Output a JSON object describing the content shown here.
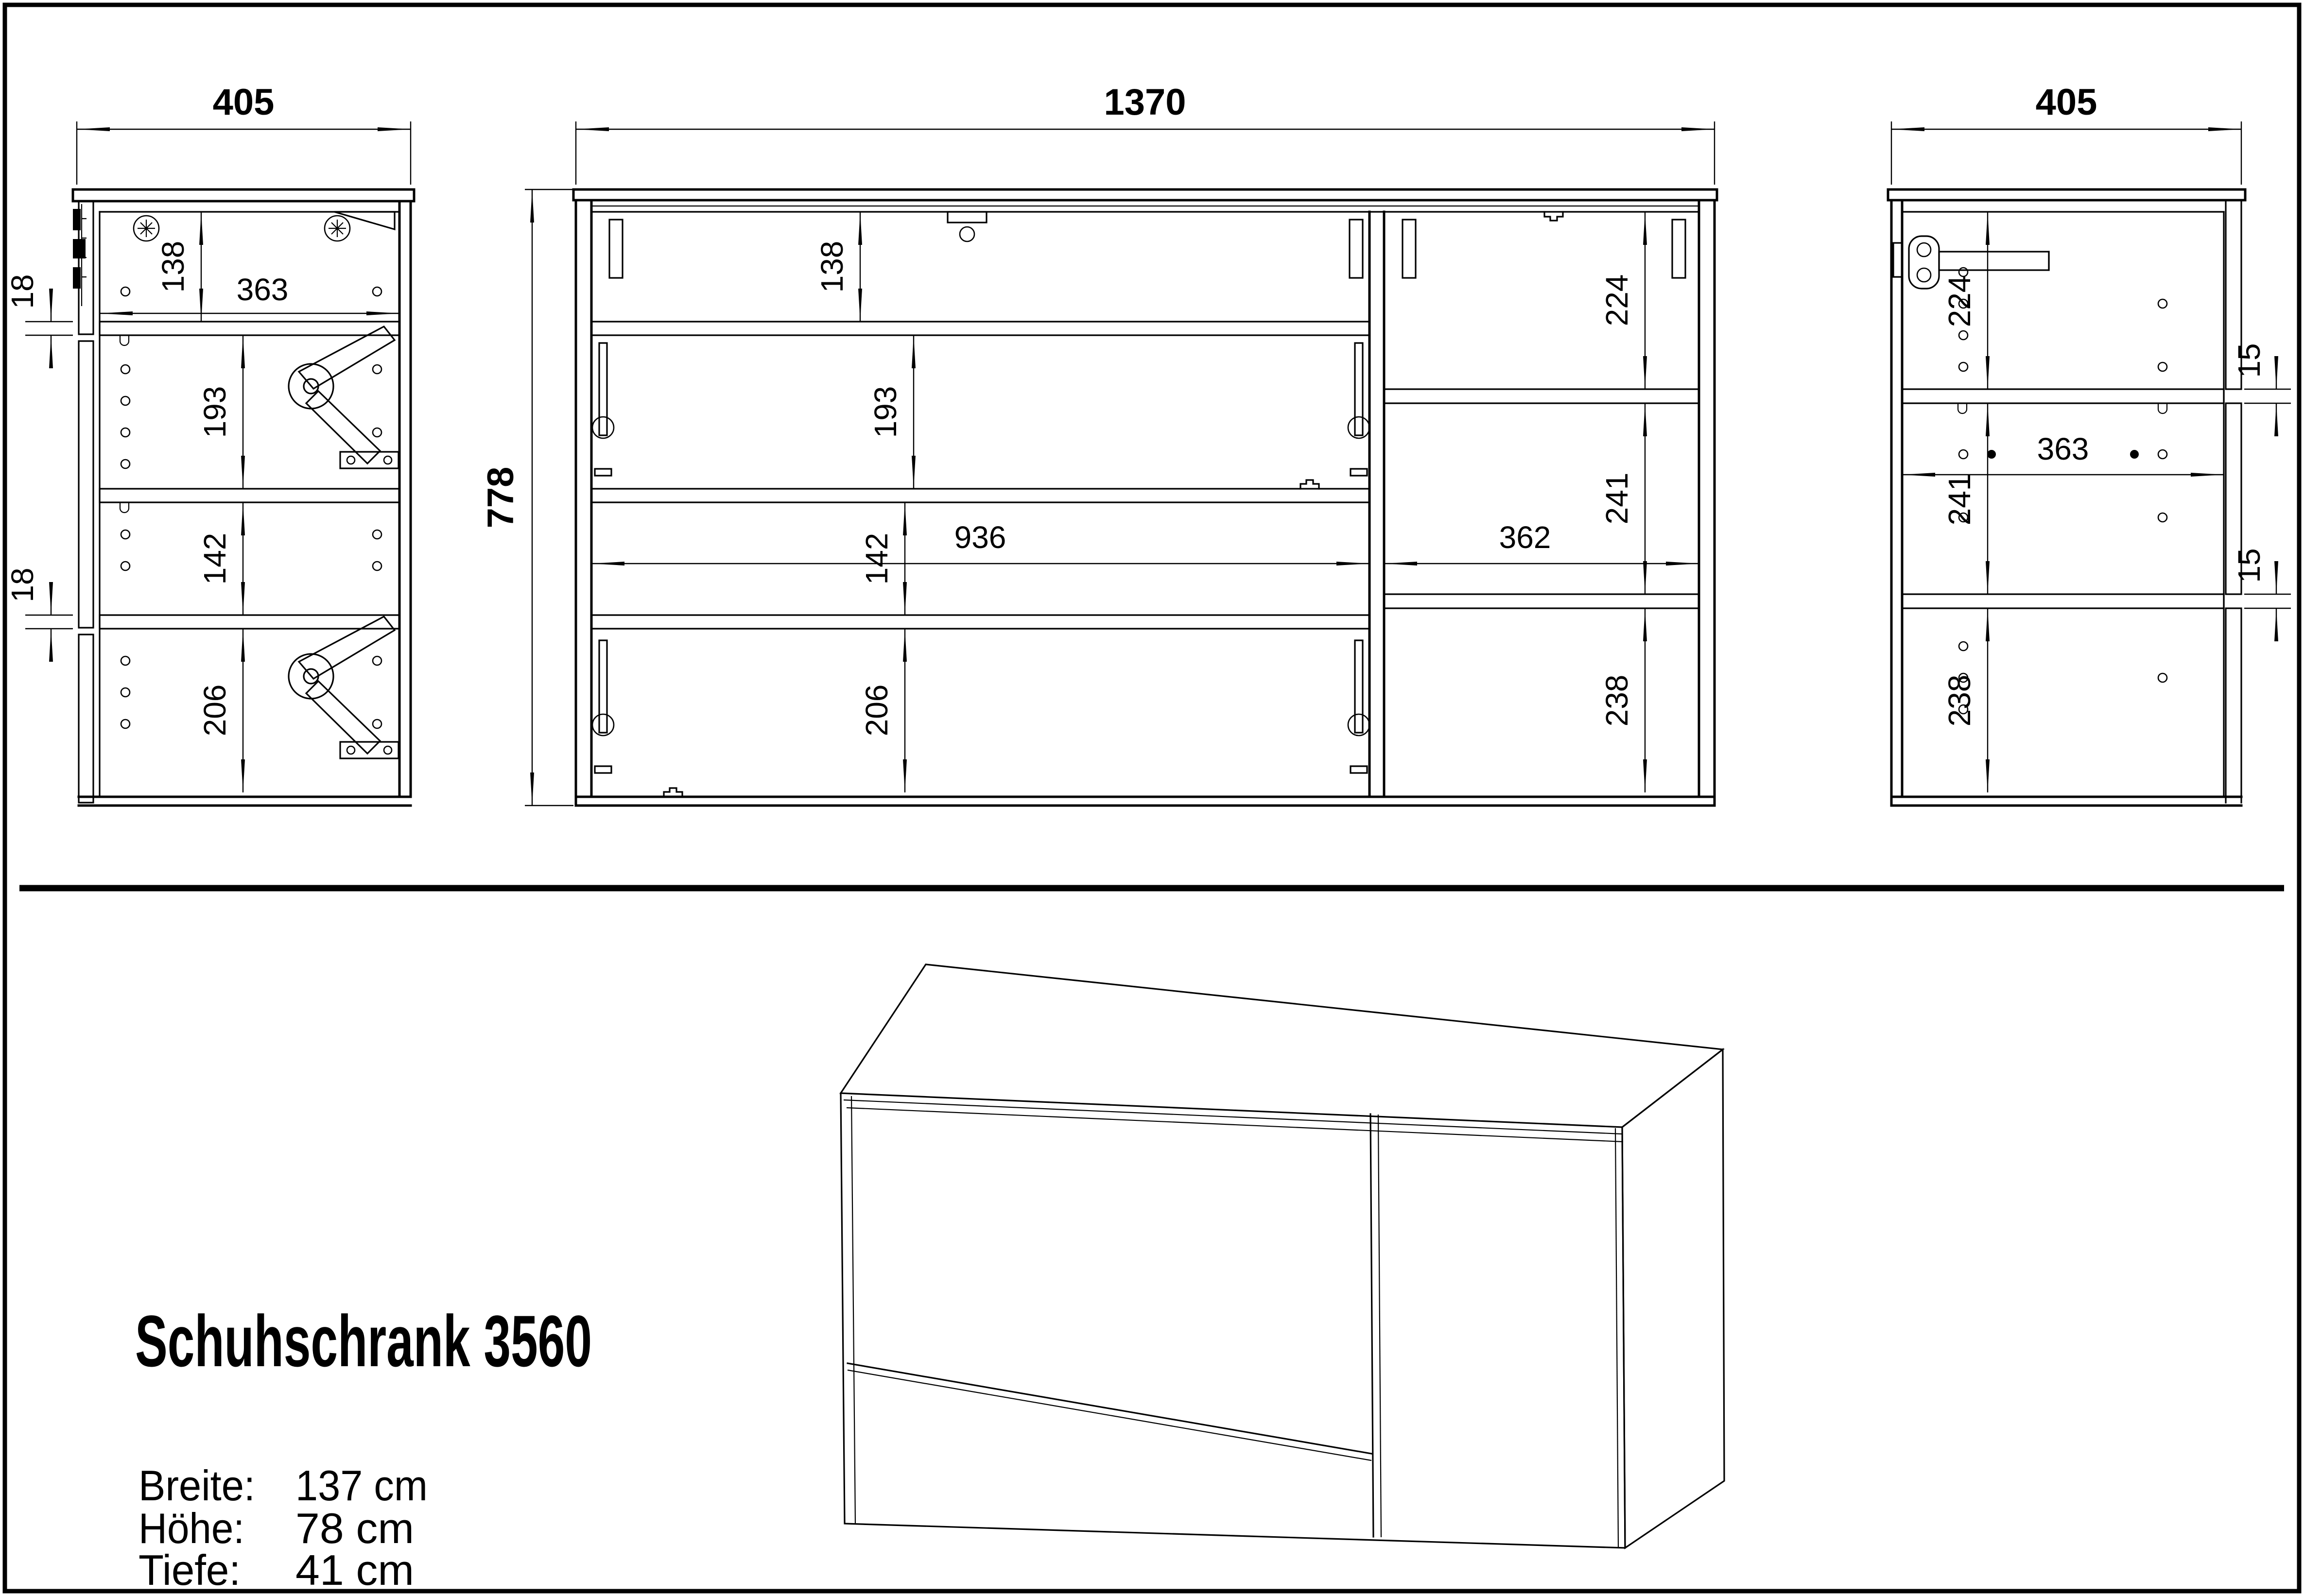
{
  "product": {
    "title": "Schuhschrank 3560",
    "specs": [
      {
        "label": "Breite:",
        "value": "137 cm"
      },
      {
        "label": "Höhe:",
        "value": "78 cm"
      },
      {
        "label": "Tiefe:",
        "value": "41 cm"
      }
    ]
  },
  "views": {
    "left_side": {
      "dims": {
        "width": "405",
        "top_compartment": "138",
        "interior_depth": "363",
        "door_gap_top": "18",
        "compartment_2": "193",
        "compartment_3": "142",
        "door_gap_bottom": "18",
        "compartment_4": "206"
      }
    },
    "front": {
      "dims": {
        "width": "1370",
        "height": "778",
        "top_compartment": "138",
        "compartment_2": "193",
        "compartment_3": "142",
        "compartment_4": "206",
        "left_interior_width": "936",
        "right_top_compartment": "224",
        "right_compartment_2": "241",
        "right_interior_width": "362",
        "right_compartment_3": "238"
      }
    },
    "right_side": {
      "dims": {
        "width": "405",
        "top_compartment": "224",
        "shelf_gap_top": "15",
        "interior_depth": "363",
        "compartment_2": "241",
        "shelf_gap_bottom": "15",
        "compartment_3": "238"
      }
    }
  },
  "icons": {
    "screw": "crosshead-screw-icon",
    "flap_stay": "flap-stay-mechanism-icon",
    "hinge_strip": "hinge-strip-icon",
    "shelf_pin": "shelf-pin-hole-icon",
    "handle_bar": "flap-stay-handle-icon"
  },
  "colors": {
    "line": "#000000",
    "background": "#ffffff"
  }
}
